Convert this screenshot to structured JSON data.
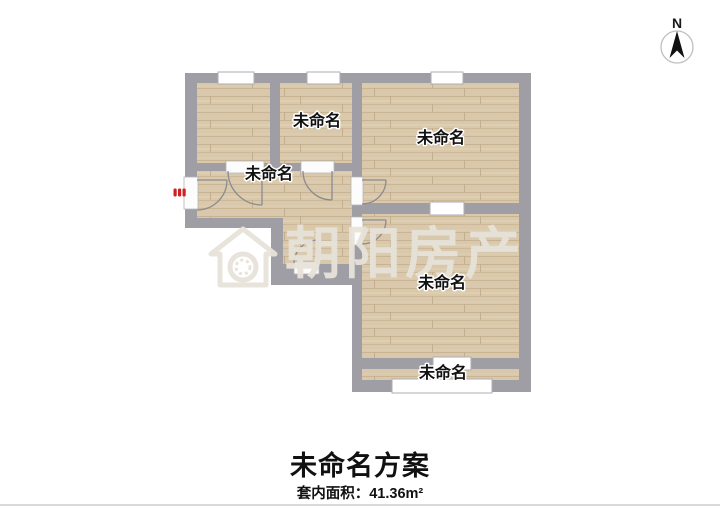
{
  "plan": {
    "rooms": [
      {
        "id": "room-top-middle",
        "label": "未命名"
      },
      {
        "id": "room-top-right",
        "label": "未命名"
      },
      {
        "id": "hallway",
        "label": "未命名"
      },
      {
        "id": "room-bottom-right",
        "label": "未命名"
      },
      {
        "id": "balcony",
        "label": "未命名"
      }
    ],
    "compass": {
      "north_label": "N"
    },
    "watermark": {
      "brand": "朝阳房产",
      "logo": "house-logo-icon"
    },
    "entrance": {
      "marker": "entrance-door-marker"
    }
  },
  "footer": {
    "title": "未命名方案",
    "area": "套内面积：41.36m²"
  },
  "colors": {
    "wall": "#9e9ea4",
    "floor": "#d9c8ab",
    "entrance_marker": "#cc2222",
    "watermark": "#e7e3da",
    "text": "#111111",
    "divider": "#d9d9d9"
  }
}
